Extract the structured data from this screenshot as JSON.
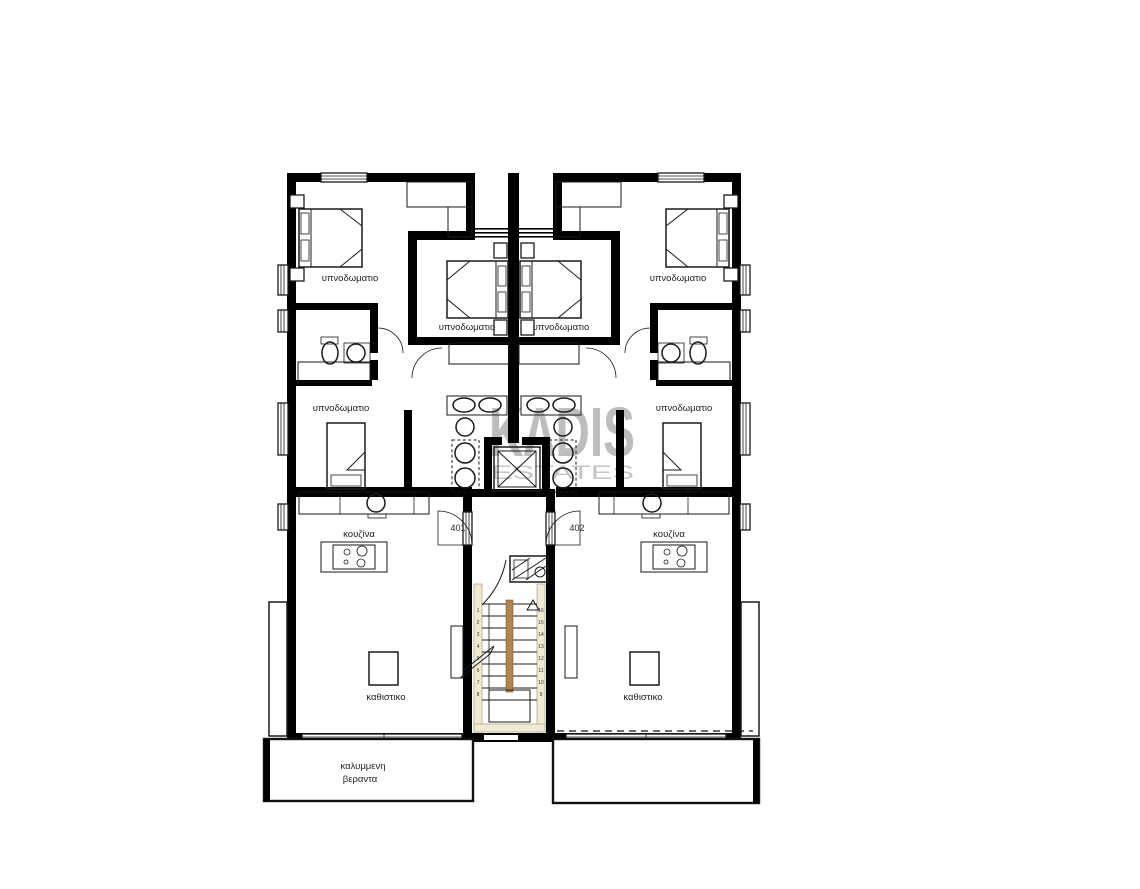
{
  "watermark": {
    "brand": "KΛDIS",
    "subtitle": "ESTATES",
    "color": "#bdbdbd"
  },
  "apartments": {
    "left_unit": "401",
    "right_unit": "402"
  },
  "room_labels": {
    "bedroom": "υπνοδωματιο",
    "kitchen": "κουζίνα",
    "living_room": "καθιστικο",
    "veranda_line1": "καλυμμενη",
    "veranda_line2": "βεραντα"
  },
  "stairs": {
    "left_step_numbers": [
      "1",
      "2",
      "3",
      "4",
      "5",
      "6",
      "7",
      "8"
    ],
    "right_step_numbers": [
      "16",
      "15",
      "14",
      "13",
      "12",
      "11",
      "10",
      "9"
    ]
  },
  "colors": {
    "wall": "#000000",
    "stair_stringer": "#b0854f",
    "stair_trim": "#f1ead3"
  }
}
